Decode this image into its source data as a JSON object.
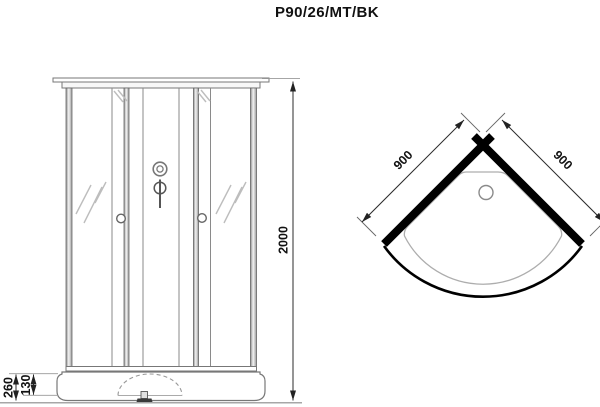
{
  "title": "P90/26/MT/BK",
  "views": {
    "front": {
      "name": "front elevation of shower cabin",
      "dimensions": {
        "height": "2000",
        "base_total_height": "260",
        "base_step_height": "130"
      }
    },
    "top": {
      "name": "top plan of quarter-circle shower tray",
      "dimensions": {
        "left_wall": "900",
        "right_wall": "900"
      }
    }
  },
  "colors": {
    "background": "#ffffff",
    "outline": "#777777",
    "thin_line": "#8a8a8a",
    "glass_mark": "#bdbdbd",
    "dimension_line": "#2b2b2b",
    "dimension_text": "#111111",
    "wall_fill": "#000000"
  }
}
